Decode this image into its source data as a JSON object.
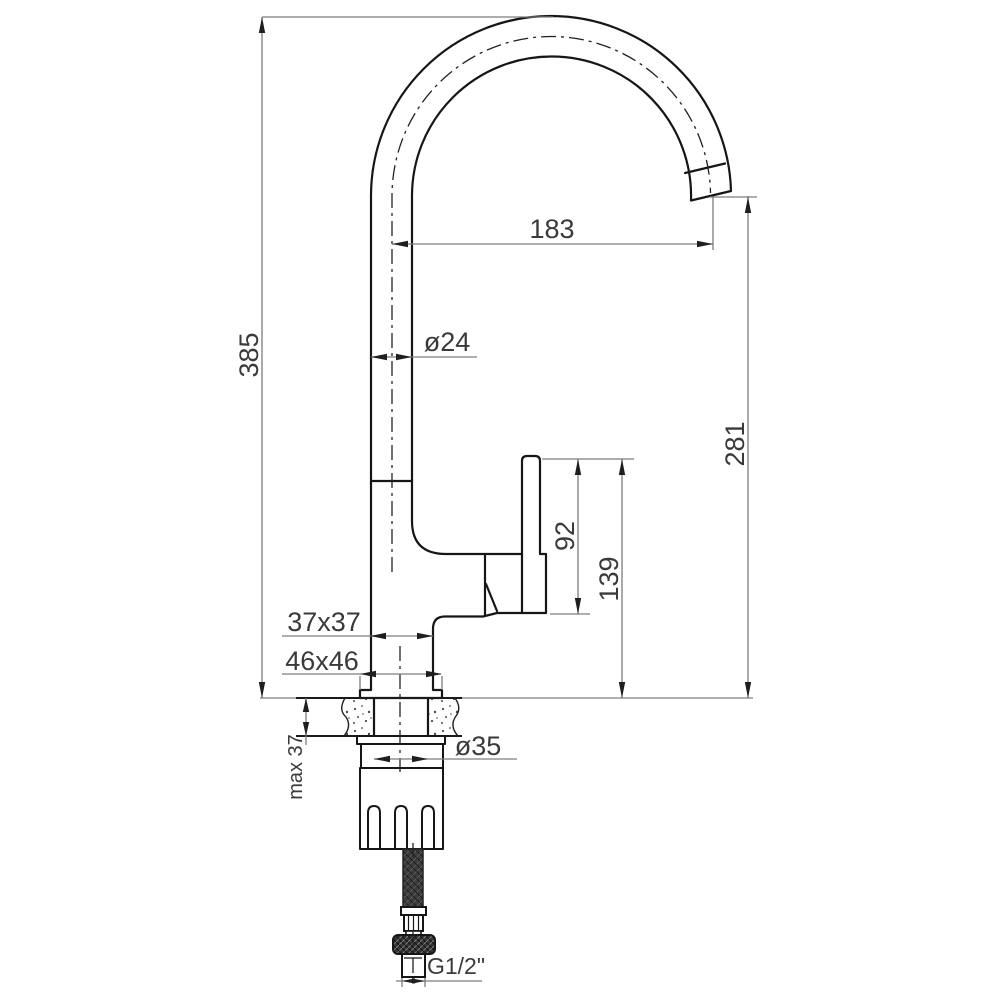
{
  "drawing": {
    "title": "Kitchen faucet dimensional technical drawing, side view",
    "labels": {
      "spout_reach": "183",
      "overall_height": "385",
      "spout_tube_diameter": "ø24",
      "outlet_height": "281",
      "lever_section_height": "92",
      "body_section_height": "139",
      "body_cross_section": "37x37",
      "base_cross_section": "46x46",
      "max_deck_thickness": "max 37",
      "mounting_hole_diameter": "ø35",
      "connection_thread": "G1/2\""
    },
    "colors": {
      "outline": "#161616",
      "dimension_line": "#7d7d7d",
      "label_text": "#3a3a3a",
      "arrow": "#1f1f1f",
      "background": "#ffffff"
    }
  }
}
